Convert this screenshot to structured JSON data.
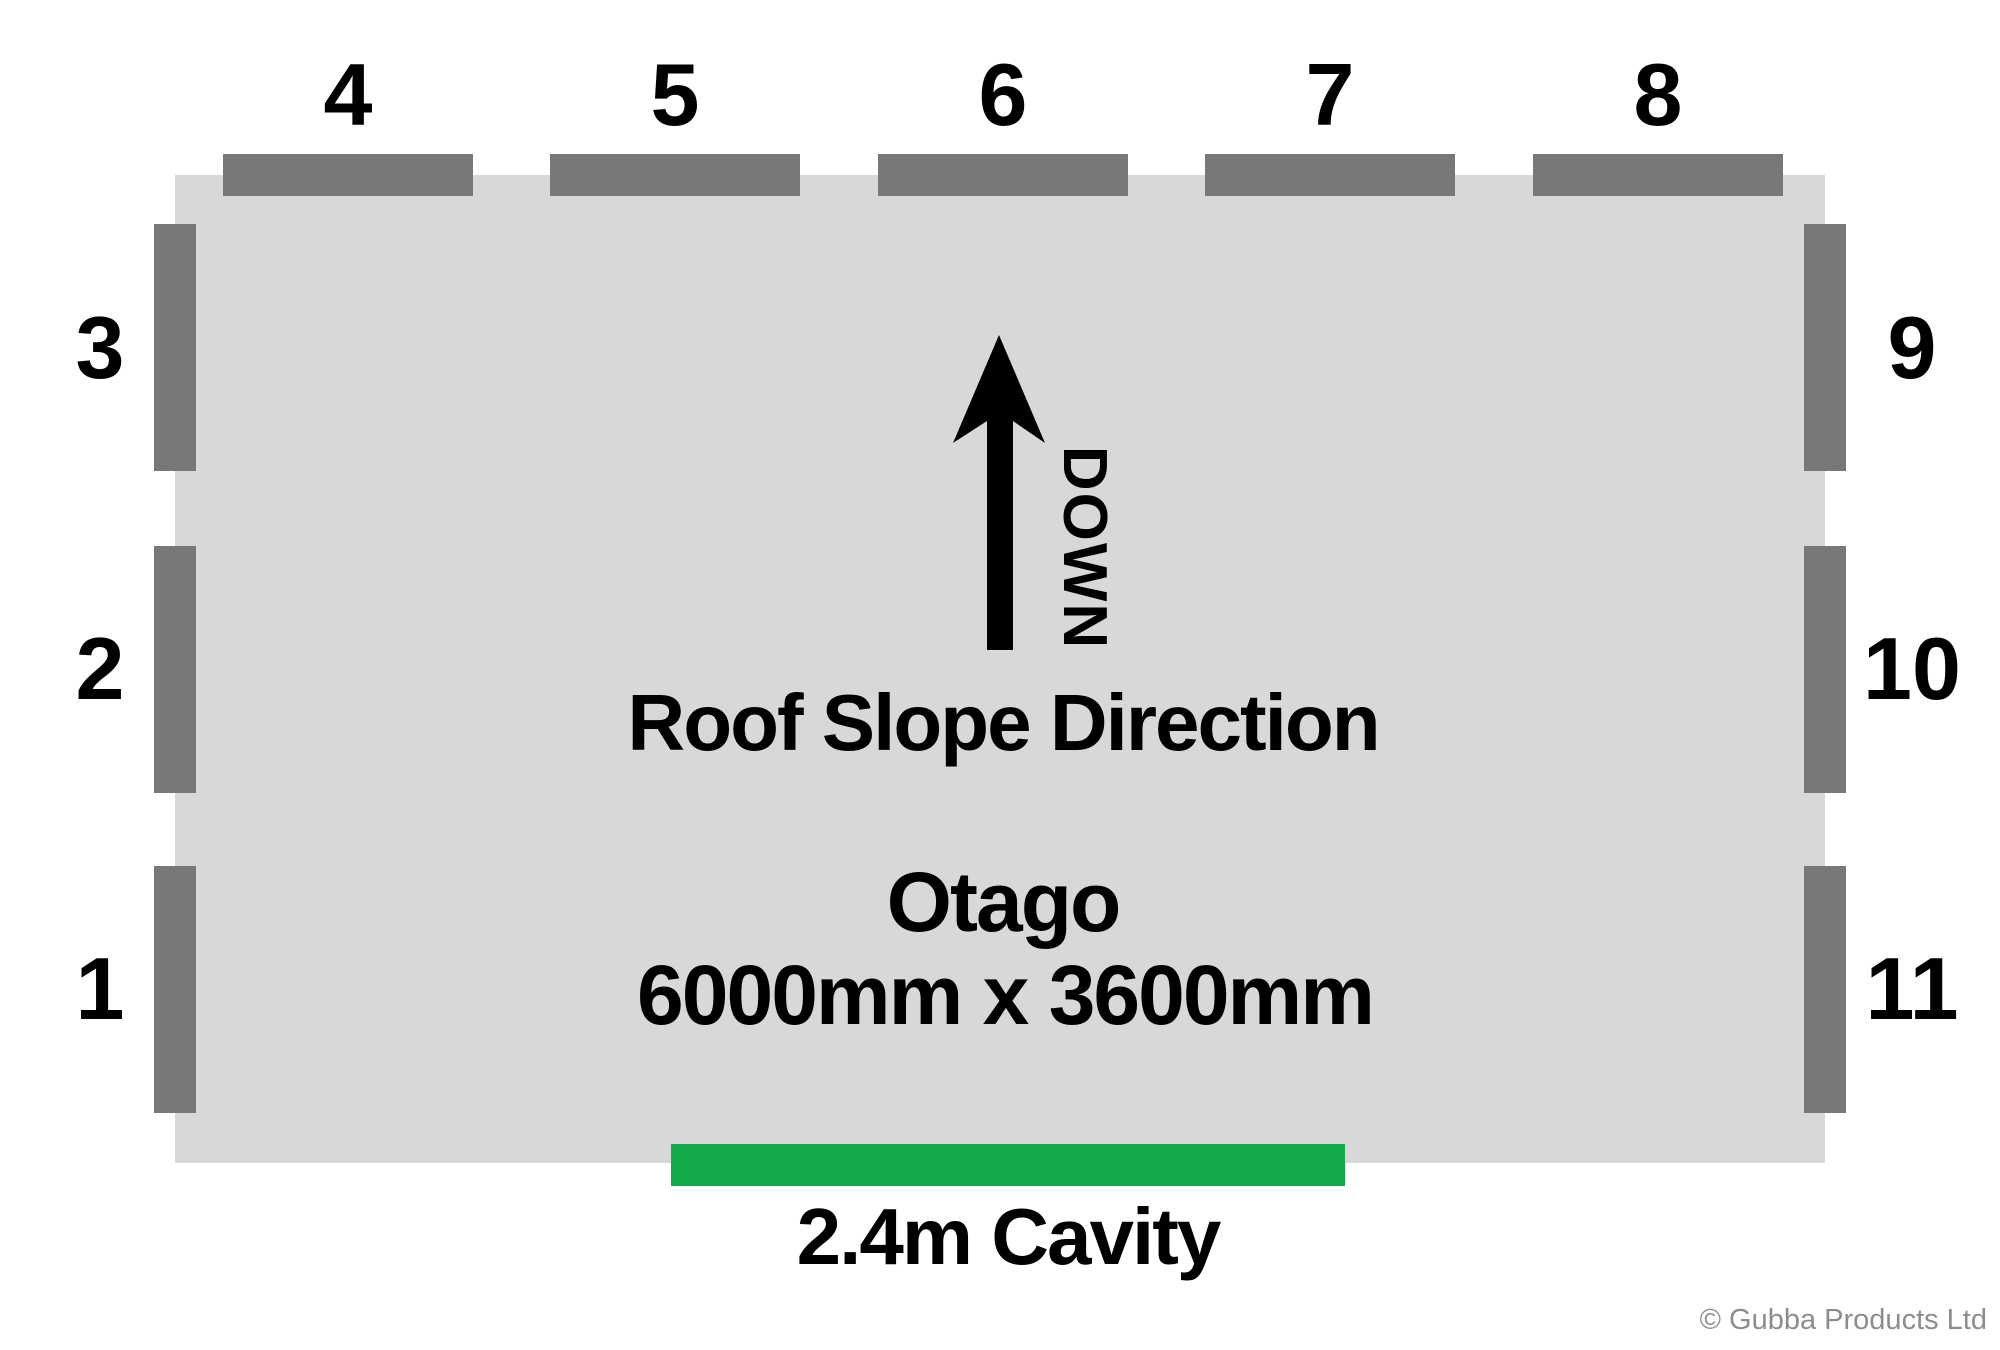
{
  "model": {
    "name": "Otago",
    "dimensions": "6000mm x 3600mm"
  },
  "roof_slope": {
    "label": "Roof Slope Direction",
    "arrow_text": "DOWN"
  },
  "cavity": {
    "label": "2.4m Cavity"
  },
  "panels": {
    "top": [
      {
        "label": "4"
      },
      {
        "label": "5"
      },
      {
        "label": "6"
      },
      {
        "label": "7"
      },
      {
        "label": "8"
      }
    ],
    "left": [
      {
        "label": "3"
      },
      {
        "label": "2"
      },
      {
        "label": "1"
      }
    ],
    "right": [
      {
        "label": "9"
      },
      {
        "label": "10"
      },
      {
        "label": "11"
      }
    ]
  },
  "copyright": "© Gubba Products Ltd",
  "colors": {
    "floor_fill": "#d8d8d8",
    "panel_fill": "#787878",
    "arrow": "#000000",
    "cavity_accent": "#14ab4a",
    "text": "#000000",
    "copyright": "#8d8d8d"
  }
}
